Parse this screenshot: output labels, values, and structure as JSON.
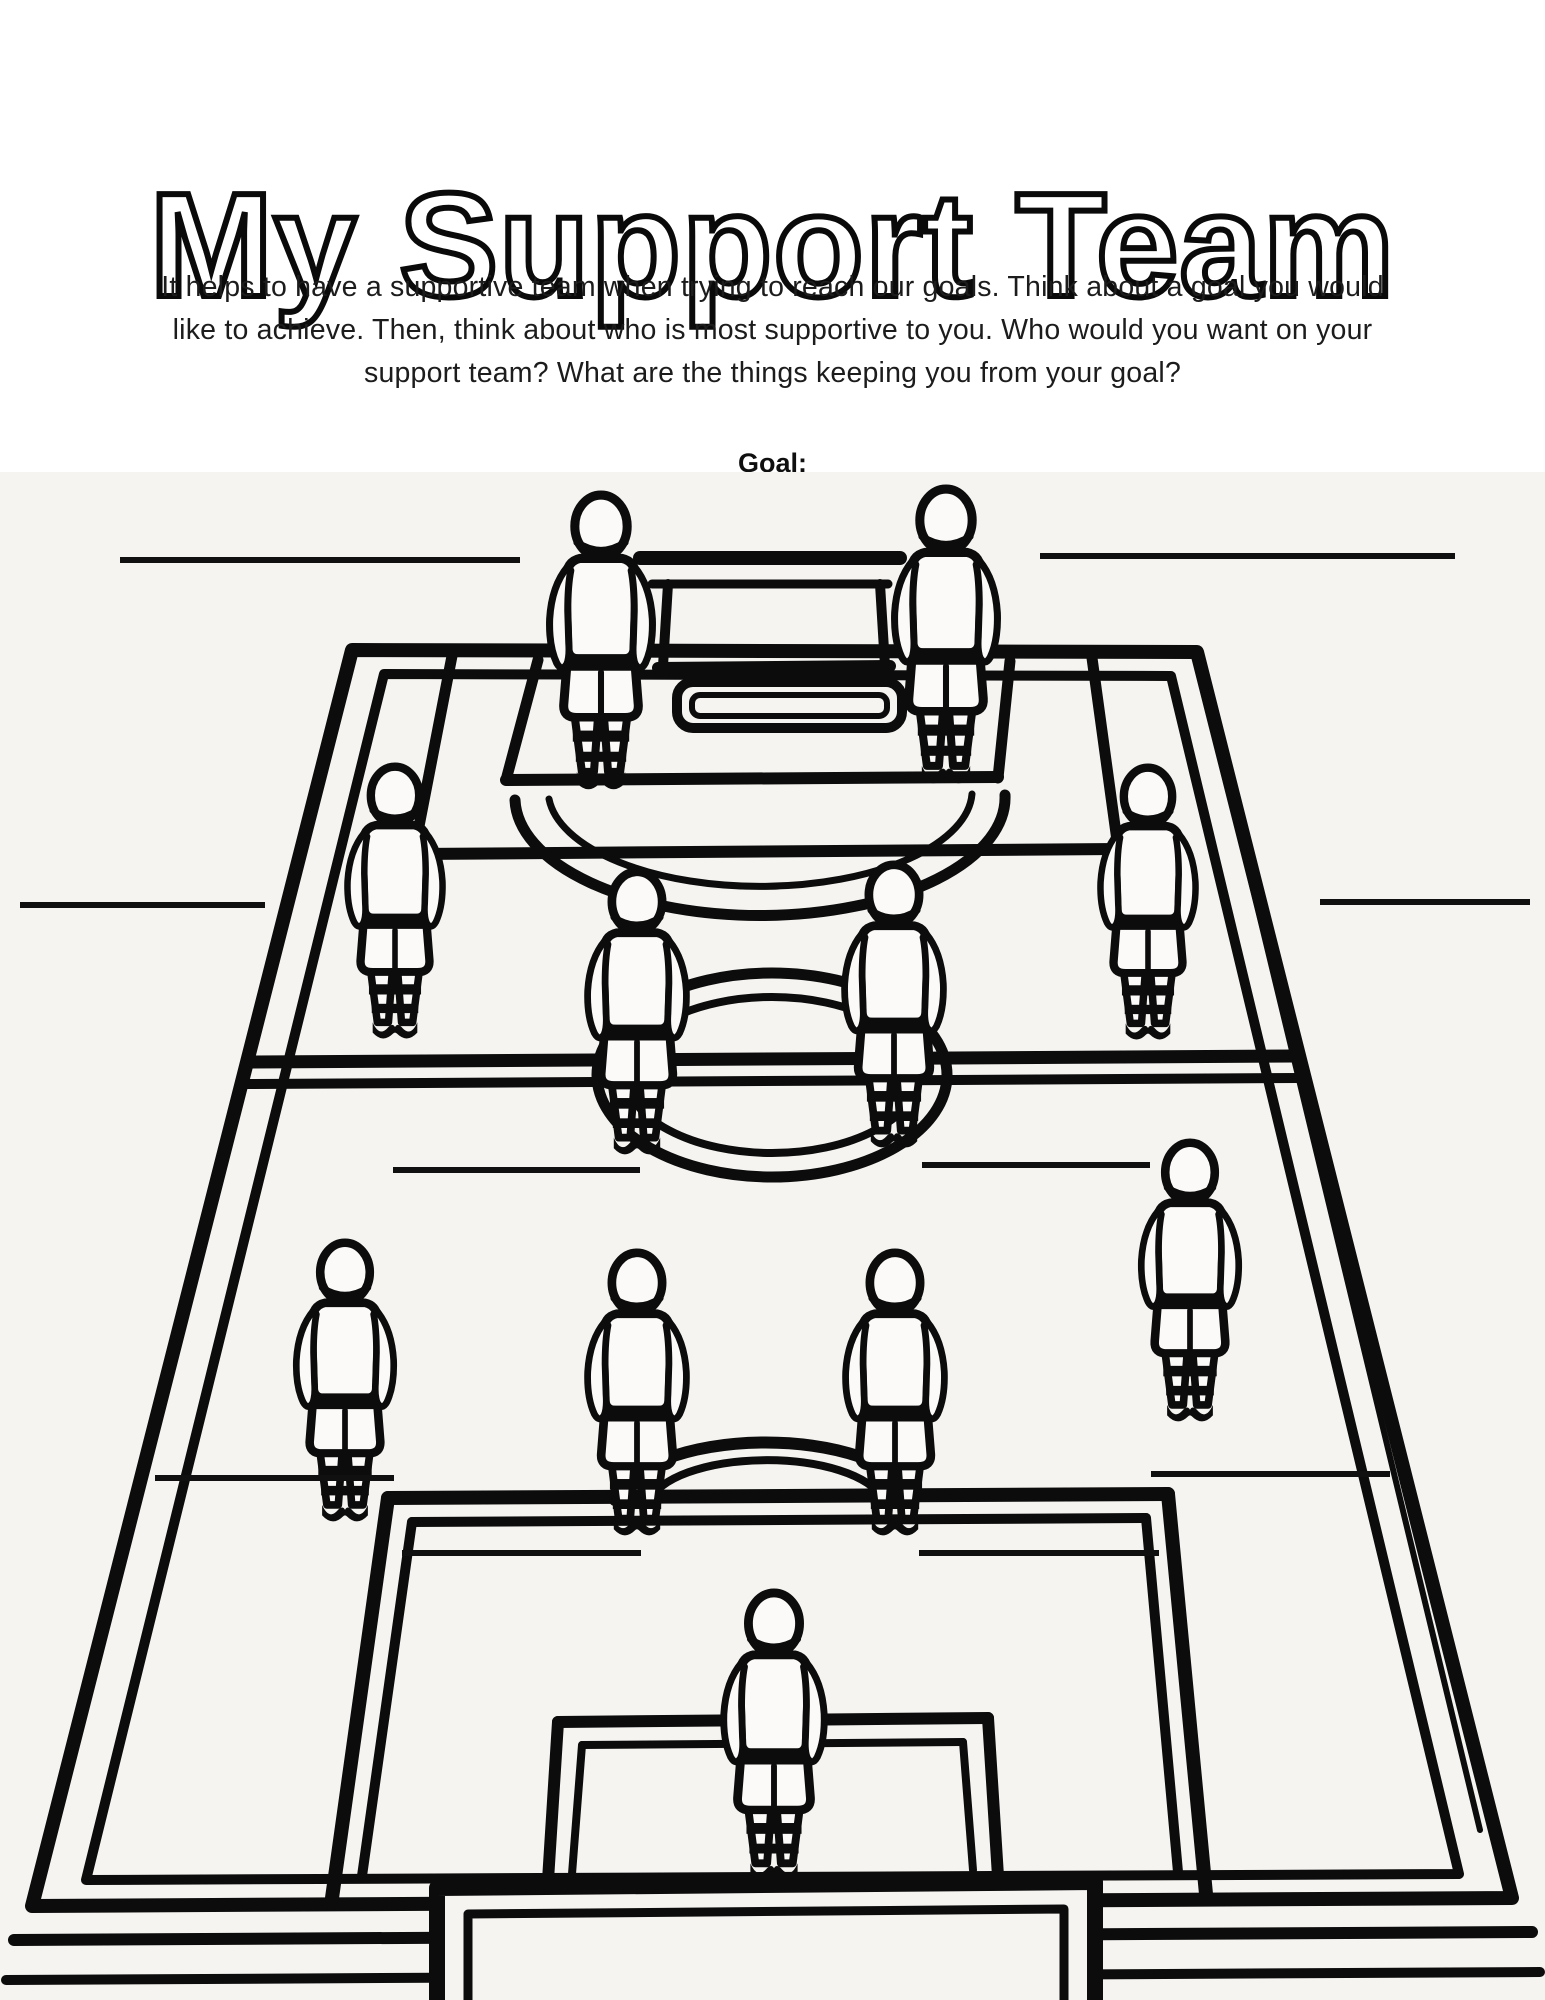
{
  "page": {
    "background": "#ffffff",
    "field_background": "#f5f4f1",
    "ink_color": "#0c0c0c"
  },
  "header": {
    "title": "My Support Team"
  },
  "intro": {
    "lines": [
      "It helps to have a supportive team when trying to reach our goals. Think about a goal you would",
      "like to achieve. Then, think about who is most supportive to you. Who would you want on your",
      "support team? What are the things keeping you from your goal?"
    ]
  },
  "goal": {
    "label": "Goal:"
  },
  "worksheet": {
    "illustration": "soccer-field-coloring-page",
    "players": [
      {
        "id": "forward-left",
        "x": 601,
        "y": 490,
        "h": 302
      },
      {
        "id": "forward-right",
        "x": 946,
        "y": 484,
        "h": 302
      },
      {
        "id": "winger-left",
        "x": 395,
        "y": 762,
        "h": 279
      },
      {
        "id": "winger-right",
        "x": 1148,
        "y": 763,
        "h": 279
      },
      {
        "id": "midfielder-left",
        "x": 637,
        "y": 867,
        "h": 290
      },
      {
        "id": "midfielder-right",
        "x": 894,
        "y": 860,
        "h": 290
      },
      {
        "id": "back-left",
        "x": 345,
        "y": 1238,
        "h": 286
      },
      {
        "id": "back-right",
        "x": 1190,
        "y": 1138,
        "h": 286
      },
      {
        "id": "center-back-left",
        "x": 637,
        "y": 1248,
        "h": 290
      },
      {
        "id": "center-back-right",
        "x": 895,
        "y": 1248,
        "h": 290
      },
      {
        "id": "goalkeeper",
        "x": 774,
        "y": 1588,
        "h": 295
      }
    ],
    "write_lines": [
      {
        "id": "top-left",
        "x1": 120,
        "x2": 520,
        "y": 560
      },
      {
        "id": "top-right",
        "x1": 1040,
        "x2": 1455,
        "y": 556
      },
      {
        "id": "upper-left",
        "x1": 20,
        "x2": 265,
        "y": 905
      },
      {
        "id": "upper-right",
        "x1": 1320,
        "x2": 1530,
        "y": 902
      },
      {
        "id": "middle-left",
        "x1": 393,
        "x2": 640,
        "y": 1170
      },
      {
        "id": "middle-right",
        "x1": 922,
        "x2": 1150,
        "y": 1165
      },
      {
        "id": "lower-left",
        "x1": 155,
        "x2": 394,
        "y": 1478
      },
      {
        "id": "lower-right",
        "x1": 1151,
        "x2": 1390,
        "y": 1474
      },
      {
        "id": "goalkeeper-left",
        "x1": 402,
        "x2": 641,
        "y": 1553
      },
      {
        "id": "goalkeeper-right",
        "x1": 919,
        "x2": 1159,
        "y": 1553
      }
    ]
  }
}
